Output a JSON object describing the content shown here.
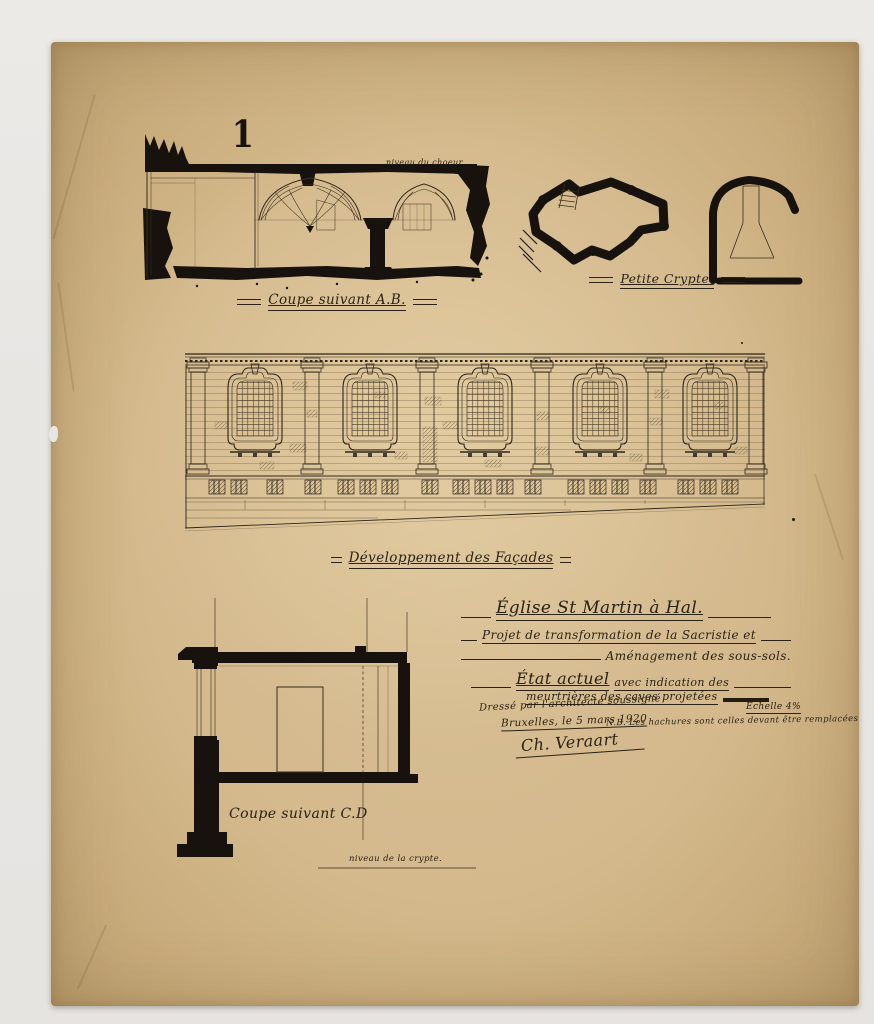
{
  "colors": {
    "background": "#e8e6e3",
    "paper": "#d3b98c",
    "paper_edge": "#bb9e6e",
    "ink": "#17120d",
    "fine_line": "#4a3a26"
  },
  "sheet_number": "1",
  "labels": {
    "section_ab": "Coupe suivant A.B.",
    "petite_crypte": "Petite Crypte.",
    "facade": "Développement des Façades",
    "section_cd": "Coupe suivant C.D",
    "niveau_choeur": "niveau du choeur",
    "niveau_crypte": "niveau de la crypte."
  },
  "title_block": {
    "church": "Église St Martin à Hal.",
    "project_line1": "Projet de transformation de la Sacristie et",
    "project_line2": "Aménagement des sous-sols.",
    "state_main": "État actuel",
    "state_rest": "avec indication des",
    "state_line2": "meurtrières des caves projetées",
    "scale": "Échelle 4%",
    "drafted_by": "Dressé par l'architecte soussigné",
    "place_date": "Bruxelles, le 5 mars 1920",
    "signature": "Ch. Veraart",
    "note": "N.B. Les hachures sont celles devant être remplacées"
  }
}
